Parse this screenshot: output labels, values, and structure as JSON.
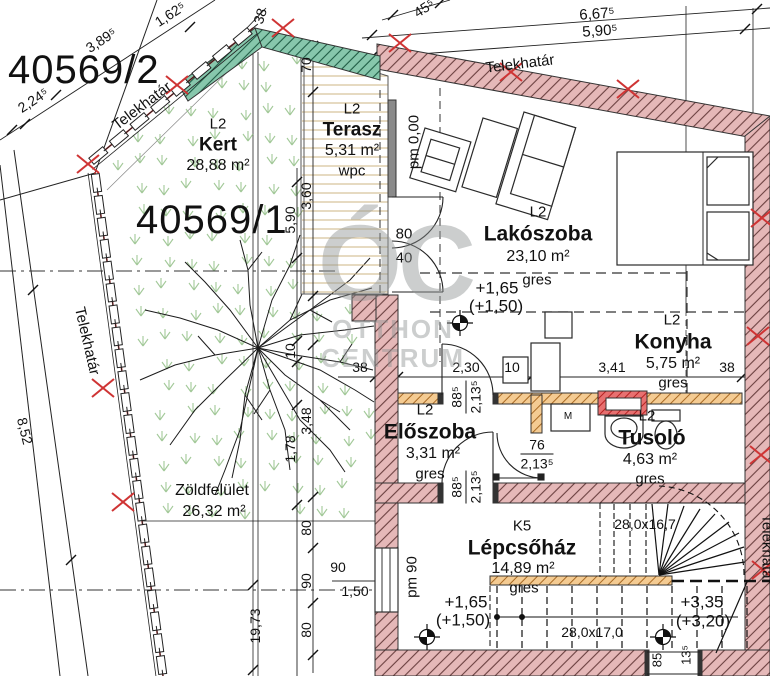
{
  "watermark": {
    "logo": "ÓC",
    "line1": "OTTHON",
    "line2": "CENTRUM"
  },
  "parcels": {
    "secondary": "40569/2",
    "main": "40569/1"
  },
  "boundary_label": "Telekhatár",
  "rooms": {
    "kert": {
      "code": "L2",
      "name": "Kert",
      "area": "28,88 m²"
    },
    "terasz": {
      "code": "L2",
      "name": "Terasz",
      "area": "5,31 m²",
      "finish": "wpc"
    },
    "lakoszoba": {
      "code": "L2",
      "name": "Lakószoba",
      "area": "23,10 m²",
      "finish": "gres"
    },
    "konyha": {
      "code": "L2",
      "name": "Konyha",
      "area": "5,75 m²",
      "finish": "gres"
    },
    "eloszoba": {
      "code": "L2",
      "name": "Előszoba",
      "area": "3,31 m²",
      "finish": "gres"
    },
    "tusolo": {
      "code": "L2",
      "name": "Tusoló",
      "area": "4,63 m²",
      "finish": "gres"
    },
    "lepcsohaz": {
      "code": "K5",
      "name": "Lépcsőház",
      "area": "14,89 m²",
      "finish": "gres"
    },
    "zoldfelulet": {
      "name": "Zöldfelület",
      "area": "26,32 m²"
    }
  },
  "levels": {
    "entry": "+1,65",
    "entry_alt": "(+1,50)",
    "upper": "+3,35",
    "upper_alt": "(+3,20)",
    "pm_zero": "pm 0,00",
    "pm_90": "pm 90"
  },
  "stairs": {
    "upper_step": "28,0x16,7",
    "lower_step": "28,0x17,0"
  },
  "appliance_washer": "M",
  "dims": {
    "plot_389": "3,89⁵",
    "plot_1625": "1,62⁵",
    "wall_38_nw": "38",
    "plot_2245": "2,24⁵",
    "plot_455": "45⁵",
    "plot_6675": "6,67⁵",
    "plot_5905": "5,90⁵",
    "terasz_70": "70",
    "terasz_360": "3,60",
    "garden_590": "5,90",
    "v_10": "10",
    "v_348": "3,48",
    "v_178": "1,78",
    "v_80a": "80",
    "v_90": "90",
    "v_80b": "80",
    "plot_1973": "19,73",
    "plot_852": "8,52",
    "win_90": "90",
    "win_150": "1,50",
    "h_38a": "38",
    "h_230": "2,30",
    "h_10": "10",
    "h_341": "3,41",
    "h_38b": "38",
    "door_80": "80",
    "door_40": "40",
    "door_76": "76",
    "door_76_h": "2,13⁵",
    "door_885a": "88⁵",
    "door_213a": "2,13⁵",
    "door_885b": "88⁵",
    "door_213b": "2,13⁵",
    "open_85": "85",
    "open_135": "13⁵"
  },
  "colors": {
    "wall": "#e5b8b8",
    "green_wall": "#87c7ac",
    "partition": "#f4cb92",
    "highlight": "#e87070",
    "grass": "#8cbb80",
    "boundary_red": "#cf3434"
  }
}
